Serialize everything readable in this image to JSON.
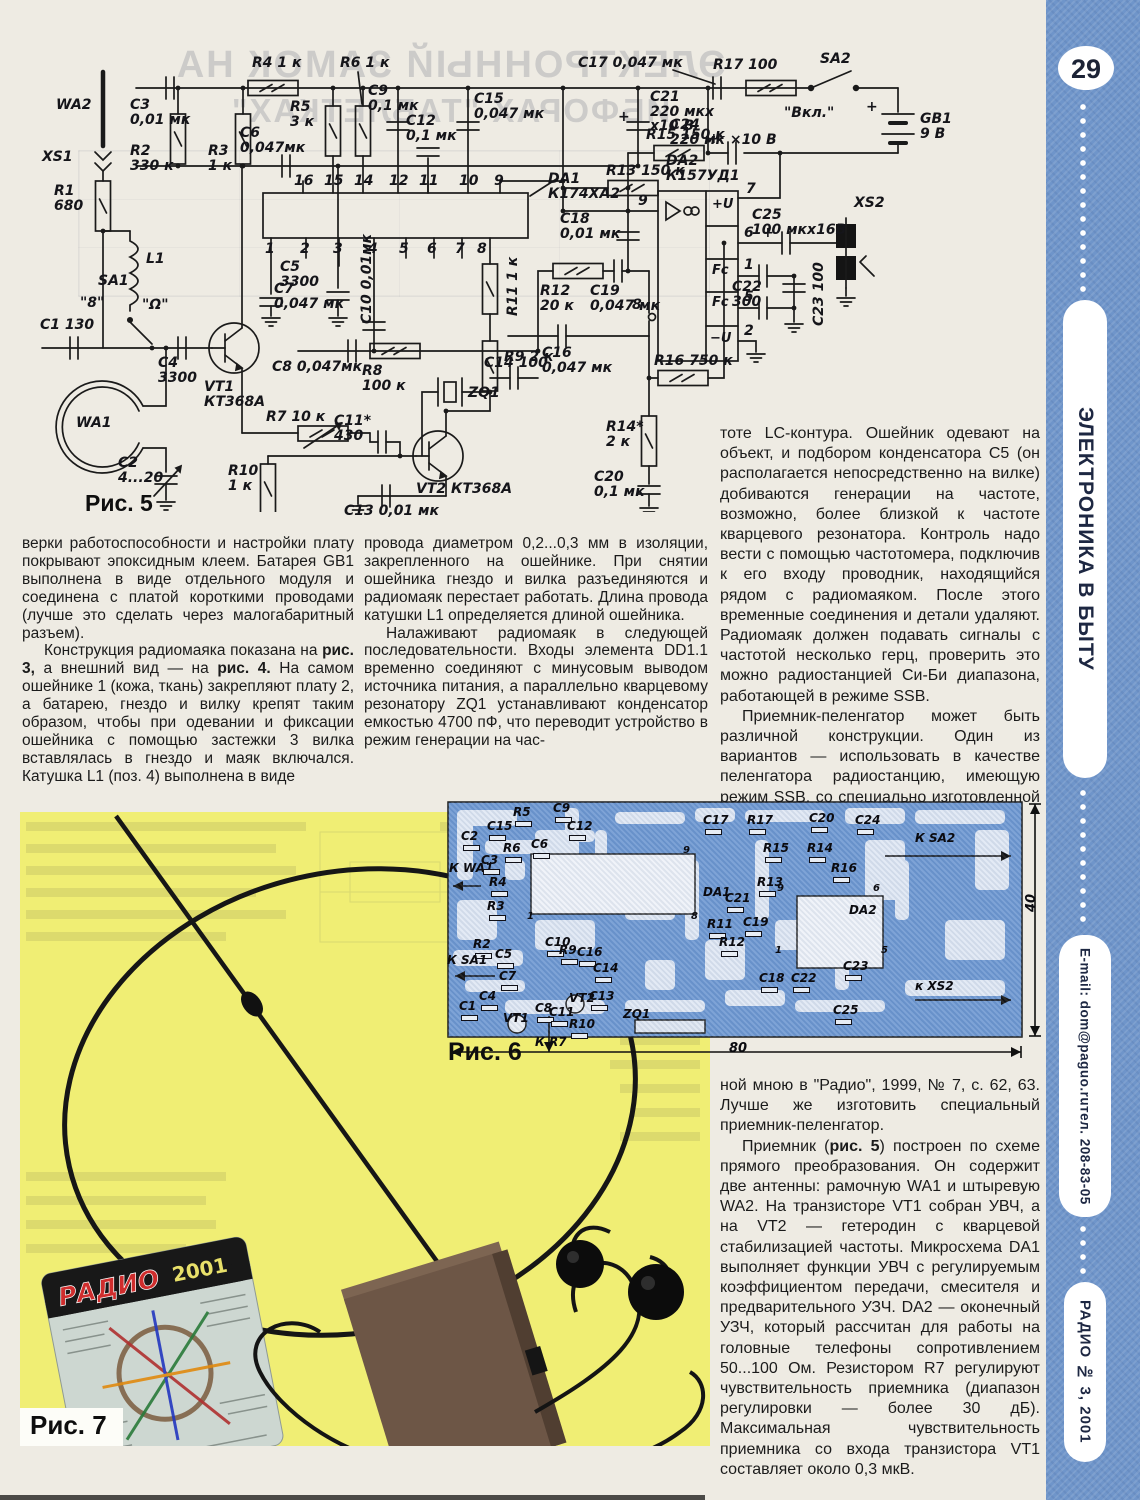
{
  "sidebar": {
    "page_number": "29",
    "section": "ЭЛЕКТРОНИКА В БЫТУ",
    "email": "E-mail: dom@paguo.ru",
    "phone": "тел. 208-83-05",
    "issue": "РАДИО № 3, 2001"
  },
  "figures": {
    "fig5": "Рис. 5",
    "fig6": "Рис. 6",
    "fig7": "Рис. 7"
  },
  "bleed": {
    "line1": "ЭЛЕКТРОННЫЙ ЗАМОК НА",
    "line2": "ИБФОРАХ \"ТАБЛЕТКАХ\""
  },
  "photo": {
    "card_brand": "РАДИО",
    "card_year": "2001"
  },
  "columns": {
    "left": [
      "верки работоспособности и настройки плату покрывают эпоксидным клеем. Батарея GB1 выполнена в виде отдельного модуля и соединена с платой короткими проводами (лучше это сделать через малогабаритный разъем).",
      "Конструкция радиомаяка показана на **рис. 3,** а внешний вид — на **рис. 4.** На самом ошейнике 1 (кожа, ткань) закрепляют плату 2, а батарею, гнездо и вилку крепят таким образом, чтобы при одевании и фиксации ошейника с помощью застежки 3 вилка вставлялась в гнездо и маяк включался. Катушка L1 (поз. 4) выполнена в виде"
    ],
    "middle": [
      "провода диаметром 0,2...0,3 мм в изоляции, закрепленного на ошейнике. При снятии ошейника гнездо и вилка разъединяются и радиомаяк перестает работать. Длина провода катушки L1 определяется длиной ошейника.",
      "Налаживают радиомаяк в следующей последовательности. Входы элемента DD1.1 временно соединяют с минусовым выводом источника питания, а параллельно кварцевому резонатору ZQ1 устанавливают конденсатор емкостью 4700 пФ, что переводит устройство в режим генерации на час-"
    ],
    "right_top": [
      "тоте LC-контура. Ошейник одевают на объект, и подбором конденсатора С5 (он располагается непосредственно на вилке) добиваются генерации на частоте, возможно, более близкой к частоте кварцевого резонатора. Контроль надо вести с помощью частотомера, подключив к его входу проводник, находящийся рядом с радиомаяком. После этого временные соединения и детали удаляют. Радиомаяк должен подавать сигналы с частотой несколько герц, проверить это можно радиостанцией Си-Би диапазона, работающей в режиме SSB.",
      "Приемник-пеленгатор может быть различной конструкции. Один из вариантов — использовать в качестве пеленгатора радиостанцию, имеющую режим SSB, со специально изготовленной антенной, например, описан-"
    ],
    "right_bottom": [
      "ной мною в \"Радио\", 1999, № 7, с. 62, 63. Лучше же изготовить специальный приемник-пеленгатор.",
      "Приемник (**рис. 5**) построен по схеме прямого преобразования. Он содержит две антенны: рамочную WA1 и штыревую WA2. На транзисторе VT1 собран УВЧ, а на VT2 — гетеродин с кварцевой стабилизацией частоты. Микросхема DA1 выполняет функции УВЧ с регулируемым коэффициентом передачи, смесителя и предварительного УЗЧ. DA2 — оконечный УЗЧ, который рассчитан для работы на головные телефоны сопротивлением 50...100 Ом. Резистором R7 регулируют чувствительность приемника (диапазон регулировки — более 30 дБ). Максимальная чувствительность приемника со входа транзистора VT1 составляет около 0,3 мкВ."
    ]
  },
  "schematic": {
    "labels": [
      {
        "t": "WA2",
        "x": 38,
        "y": 72
      },
      {
        "t": "XS1",
        "x": 24,
        "y": 124
      },
      {
        "t": "R1\n680",
        "x": 36,
        "y": 158
      },
      {
        "t": "C3\n0,01 мк",
        "x": 112,
        "y": 72
      },
      {
        "t": "R2\n330 к",
        "x": 112,
        "y": 118
      },
      {
        "t": "R3\n1 к",
        "x": 190,
        "y": 118
      },
      {
        "t": "С6\n0,047мк",
        "x": 222,
        "y": 100
      },
      {
        "t": "R4 1 к",
        "x": 234,
        "y": 30
      },
      {
        "t": "R5\n3 к",
        "x": 272,
        "y": 74
      },
      {
        "t": "R6 1 к",
        "x": 322,
        "y": 30
      },
      {
        "t": "С9\n0,1 мк",
        "x": 350,
        "y": 58
      },
      {
        "t": "С12\n0,1 мк",
        "x": 388,
        "y": 88
      },
      {
        "t": "С15\n0,047 мк",
        "x": 456,
        "y": 66
      },
      {
        "t": "С17 0,047 мк",
        "x": 560,
        "y": 30
      },
      {
        "t": "С21\n220 мкх\nх10 В",
        "x": 632,
        "y": 64
      },
      {
        "t": "+",
        "x": 600,
        "y": 84
      },
      {
        "t": "R17 100",
        "x": 695,
        "y": 32
      },
      {
        "t": "SA2",
        "x": 802,
        "y": 26
      },
      {
        "t": "\"Вкл.\"",
        "x": 766,
        "y": 80
      },
      {
        "t": "GB1\n9 В",
        "x": 902,
        "y": 86
      },
      {
        "t": "+",
        "x": 848,
        "y": 74
      },
      {
        "t": "С24\n220 мк ×10 В",
        "x": 652,
        "y": 92
      },
      {
        "t": "+",
        "x": 690,
        "y": 106
      },
      {
        "t": "R15 150 к",
        "x": 628,
        "y": 102
      },
      {
        "t": "R13 150 к",
        "x": 588,
        "y": 138
      },
      {
        "t": "DA1\nК174ХА2",
        "x": 530,
        "y": 146
      },
      {
        "t": "DA2\nК157УД1",
        "x": 648,
        "y": 128
      },
      {
        "t": "16",
        "x": 276,
        "y": 148
      },
      {
        "t": "15",
        "x": 306,
        "y": 148
      },
      {
        "t": "14",
        "x": 336,
        "y": 148
      },
      {
        "t": "12",
        "x": 371,
        "y": 148
      },
      {
        "t": "11",
        "x": 401,
        "y": 148
      },
      {
        "t": "10",
        "x": 441,
        "y": 148
      },
      {
        "t": "9",
        "x": 476,
        "y": 148
      },
      {
        "t": "1",
        "x": 247,
        "y": 216
      },
      {
        "t": "2",
        "x": 282,
        "y": 216
      },
      {
        "t": "3",
        "x": 315,
        "y": 216
      },
      {
        "t": "4",
        "x": 350,
        "y": 216
      },
      {
        "t": "5",
        "x": 381,
        "y": 216
      },
      {
        "t": "6",
        "x": 409,
        "y": 216
      },
      {
        "t": "7",
        "x": 437,
        "y": 216
      },
      {
        "t": "8",
        "x": 459,
        "y": 216
      },
      {
        "t": "С18\n0,01 мк",
        "x": 542,
        "y": 186
      },
      {
        "t": "С5\n3300",
        "x": 262,
        "y": 234
      },
      {
        "t": "L1",
        "x": 128,
        "y": 226
      },
      {
        "t": "С25\n100 мкх16В",
        "x": 734,
        "y": 182
      },
      {
        "t": "+",
        "x": 744,
        "y": 200
      },
      {
        "t": "XS2",
        "x": 836,
        "y": 170
      },
      {
        "t": "С7\n0,047 мк",
        "x": 256,
        "y": 256
      },
      {
        "t": "С8 0,047мк",
        "x": 254,
        "y": 334
      },
      {
        "t": "R8\n100 к",
        "x": 344,
        "y": 338
      },
      {
        "t": "R7 10 к",
        "x": 248,
        "y": 384
      },
      {
        "t": "С11*\n430",
        "x": 316,
        "y": 388
      },
      {
        "t": "VT1\nКТ368А",
        "x": 186,
        "y": 354
      },
      {
        "t": "WA1",
        "x": 58,
        "y": 390
      },
      {
        "t": "SA1",
        "x": 80,
        "y": 248
      },
      {
        "t": "\"8\"",
        "x": 62,
        "y": 270
      },
      {
        "t": "\"Ω\"",
        "x": 124,
        "y": 272
      },
      {
        "t": "С1 130",
        "x": 22,
        "y": 292
      },
      {
        "t": "С4\n3300",
        "x": 140,
        "y": 330
      },
      {
        "t": "С2\n4...20",
        "x": 100,
        "y": 430
      },
      {
        "t": "R10\n1 к",
        "x": 210,
        "y": 438
      },
      {
        "t": "С13 0,01 мк",
        "x": 326,
        "y": 478
      },
      {
        "t": "VT2 КТ368А",
        "x": 398,
        "y": 456
      },
      {
        "t": "ZQ1",
        "x": 450,
        "y": 360
      },
      {
        "t": "С10 0,01мк",
        "x": 342,
        "y": 298,
        "r": -90
      },
      {
        "t": "R11 1 к",
        "x": 488,
        "y": 290,
        "r": -90
      },
      {
        "t": "R9 2 к",
        "x": 486,
        "y": 324
      },
      {
        "t": "С14 100",
        "x": 466,
        "y": 330
      },
      {
        "t": "R12\n20 к",
        "x": 522,
        "y": 258
      },
      {
        "t": "С19\n0,047 мк",
        "x": 572,
        "y": 258
      },
      {
        "t": "С16\n0,047 мк",
        "x": 524,
        "y": 320
      },
      {
        "t": "R16 750 к",
        "x": 636,
        "y": 328
      },
      {
        "t": "R14*\n2 к",
        "x": 588,
        "y": 394
      },
      {
        "t": "С20\n0,1 мк",
        "x": 576,
        "y": 444
      },
      {
        "t": "С22\n300",
        "x": 714,
        "y": 254
      },
      {
        "t": "С23 100",
        "x": 794,
        "y": 300,
        "r": -90
      },
      {
        "t": "+U",
        "x": 694,
        "y": 172,
        "fs": 13
      },
      {
        "t": "Fc",
        "x": 694,
        "y": 238,
        "fs": 13
      },
      {
        "t": "Fc",
        "x": 694,
        "y": 270,
        "fs": 13
      },
      {
        "t": "−U",
        "x": 692,
        "y": 306,
        "fs": 13
      },
      {
        "t": "7",
        "x": 728,
        "y": 156
      },
      {
        "t": "6",
        "x": 726,
        "y": 200
      },
      {
        "t": "1",
        "x": 726,
        "y": 232
      },
      {
        "t": "5",
        "x": 726,
        "y": 264
      },
      {
        "t": "2",
        "x": 726,
        "y": 298
      },
      {
        "t": "9",
        "x": 620,
        "y": 168
      },
      {
        "t": "8",
        "x": 614,
        "y": 272
      }
    ]
  },
  "pcb": {
    "labels": [
      {
        "t": "С2",
        "x": 16,
        "y": 30,
        "g": 1
      },
      {
        "t": "С15",
        "x": 42,
        "y": 20,
        "g": 1
      },
      {
        "t": "R5",
        "x": 68,
        "y": 6,
        "g": 1
      },
      {
        "t": "С9",
        "x": 108,
        "y": 2,
        "g": 1
      },
      {
        "t": "С12",
        "x": 122,
        "y": 20,
        "g": 1
      },
      {
        "t": "R6",
        "x": 58,
        "y": 42,
        "g": 1
      },
      {
        "t": "С6",
        "x": 86,
        "y": 38,
        "g": 1
      },
      {
        "t": "К WA1",
        "x": 4,
        "y": 62,
        "b": 1
      },
      {
        "t": "С3",
        "x": 36,
        "y": 54,
        "g": 1
      },
      {
        "t": "R4",
        "x": 44,
        "y": 76,
        "g": 1
      },
      {
        "t": "R3",
        "x": 42,
        "y": 100,
        "g": 1
      },
      {
        "t": "R2",
        "x": 28,
        "y": 138,
        "g": 1
      },
      {
        "t": "К SA1",
        "x": 2,
        "y": 154,
        "b": 1
      },
      {
        "t": "С5",
        "x": 50,
        "y": 148,
        "g": 1
      },
      {
        "t": "С7",
        "x": 54,
        "y": 170,
        "g": 1
      },
      {
        "t": "С1",
        "x": 14,
        "y": 200,
        "g": 1
      },
      {
        "t": "С4",
        "x": 34,
        "y": 190,
        "g": 1
      },
      {
        "t": "VT1",
        "x": 58,
        "y": 212
      },
      {
        "t": "С8",
        "x": 90,
        "y": 202,
        "g": 1
      },
      {
        "t": "С10",
        "x": 100,
        "y": 136,
        "g": 1
      },
      {
        "t": "С11",
        "x": 104,
        "y": 206,
        "g": 1
      },
      {
        "t": "R9",
        "x": 114,
        "y": 144,
        "g": 1
      },
      {
        "t": "VT2",
        "x": 124,
        "y": 192
      },
      {
        "t": "С16",
        "x": 132,
        "y": 146,
        "g": 1
      },
      {
        "t": "С14",
        "x": 148,
        "y": 162,
        "g": 1
      },
      {
        "t": "С13",
        "x": 144,
        "y": 190,
        "g": 1
      },
      {
        "t": "R10",
        "x": 124,
        "y": 218,
        "g": 1
      },
      {
        "t": "ZQ1",
        "x": 178,
        "y": 208
      },
      {
        "t": "К R7",
        "x": 90,
        "y": 236,
        "b": 1
      },
      {
        "t": "1",
        "x": 82,
        "y": 112,
        "fs": 10
      },
      {
        "t": "9",
        "x": 238,
        "y": 46,
        "fs": 10
      },
      {
        "t": "8",
        "x": 246,
        "y": 112,
        "fs": 10
      },
      {
        "t": "DA1",
        "x": 258,
        "y": 86
      },
      {
        "t": "С21",
        "x": 280,
        "y": 92,
        "g": 1
      },
      {
        "t": "С17",
        "x": 258,
        "y": 14,
        "g": 1
      },
      {
        "t": "R17",
        "x": 302,
        "y": 14,
        "g": 1
      },
      {
        "t": "С20",
        "x": 364,
        "y": 12,
        "g": 1
      },
      {
        "t": "С24",
        "x": 410,
        "y": 14,
        "g": 1
      },
      {
        "t": "К SA2",
        "x": 470,
        "y": 32,
        "b": 1
      },
      {
        "t": "R15",
        "x": 318,
        "y": 42,
        "g": 1
      },
      {
        "t": "R14",
        "x": 362,
        "y": 42,
        "g": 1
      },
      {
        "t": "R16",
        "x": 386,
        "y": 62,
        "g": 1
      },
      {
        "t": "R13",
        "x": 312,
        "y": 76,
        "g": 1
      },
      {
        "t": "С19",
        "x": 298,
        "y": 116,
        "g": 1
      },
      {
        "t": "9",
        "x": 332,
        "y": 84,
        "fs": 10
      },
      {
        "t": "6",
        "x": 428,
        "y": 84,
        "fs": 10
      },
      {
        "t": "DA2",
        "x": 404,
        "y": 104
      },
      {
        "t": "R11",
        "x": 262,
        "y": 118,
        "g": 1
      },
      {
        "t": "R12",
        "x": 274,
        "y": 136,
        "g": 1
      },
      {
        "t": "С18",
        "x": 314,
        "y": 172,
        "g": 1
      },
      {
        "t": "С22",
        "x": 346,
        "y": 172,
        "g": 1
      },
      {
        "t": "С23",
        "x": 398,
        "y": 160,
        "g": 1
      },
      {
        "t": "1",
        "x": 330,
        "y": 146,
        "fs": 10
      },
      {
        "t": "5",
        "x": 436,
        "y": 146,
        "fs": 10
      },
      {
        "t": "С25",
        "x": 388,
        "y": 204,
        "g": 1
      },
      {
        "t": "к XS2",
        "x": 470,
        "y": 180,
        "b": 1
      },
      {
        "t": "80",
        "x": 284,
        "y": 242,
        "fs": 13
      },
      {
        "t": "40",
        "x": 580,
        "y": 112,
        "r": -90,
        "fs": 13
      }
    ]
  }
}
